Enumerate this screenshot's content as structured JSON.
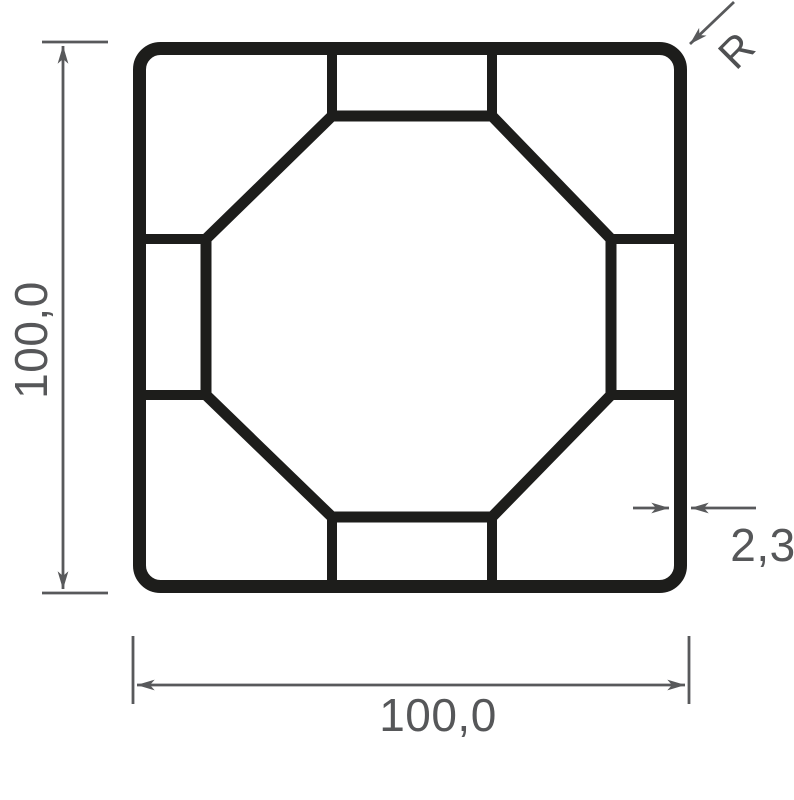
{
  "drawing": {
    "type": "profile-cross-section",
    "labels": {
      "height": "100,0",
      "width": "100,0",
      "thickness": "2,3",
      "radius": "R"
    },
    "colors": {
      "profile_wall": "#1d1d1b",
      "dimension_lines": "#58595b",
      "dimension_text": "#565759",
      "background": "#ffffff"
    }
  }
}
